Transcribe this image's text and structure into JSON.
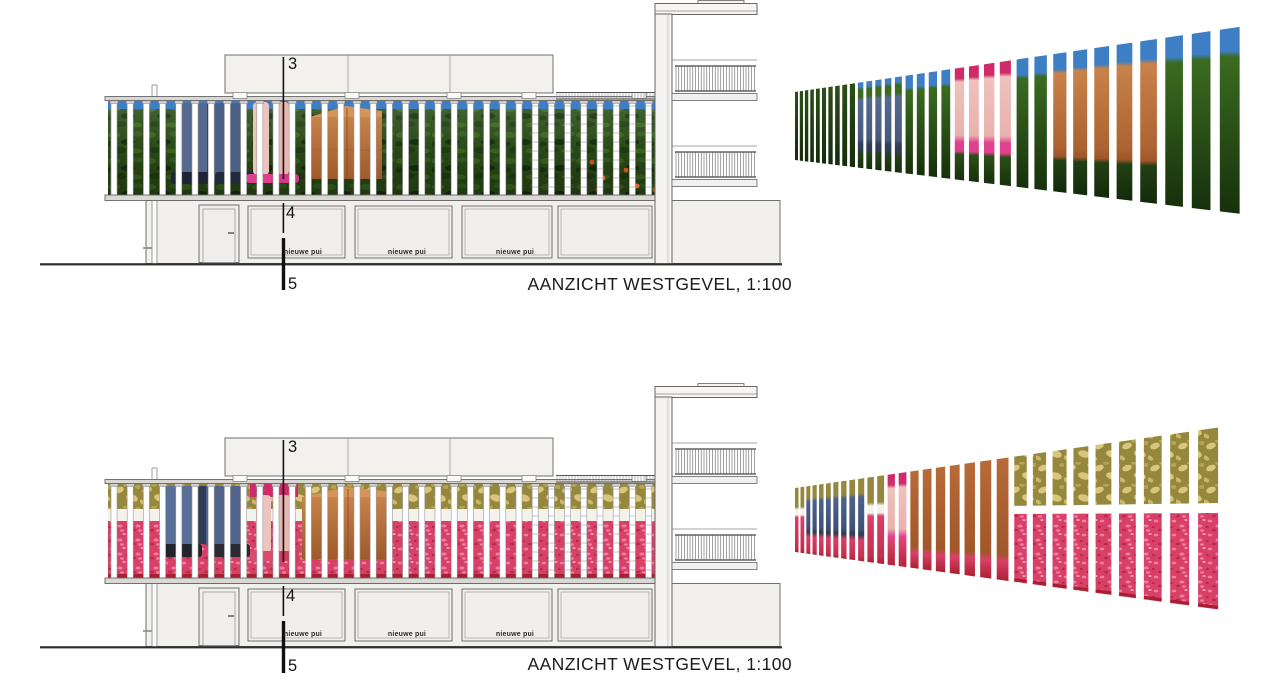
{
  "document": {
    "kind": "architectural elevation sheet",
    "drawing_title": "AANZICHT WESTGEVEL",
    "scale": "1:100"
  },
  "captions": {
    "top": "AANZICHT WESTGEVEL, 1:100",
    "bottom": "AANZICHT WESTGEVEL, 1:100"
  },
  "section_markers": {
    "m3": "3",
    "m4": "4",
    "m5": "5"
  },
  "panel_label": "nieuwe pui",
  "palette": {
    "line": "#4a4a4a",
    "wall_fill": "#f1f0ed",
    "wall_stroke": "#6f6f6f",
    "rail_fill": "#d9d8d4",
    "sky_blue": "#3d7ec4",
    "grass_base": "#2c4f18",
    "grass_light": "#3b6b20",
    "grass_dark": "#16300c",
    "denim": "#56698e",
    "denim_dark": "#2e3c55",
    "skin": "#eec2bd",
    "flipflop_pink": "#e0418f",
    "magenta": "#cf2a6a",
    "box_brown": "#c07a42",
    "box_brown_dark": "#9e5a2b",
    "olive": "#95883e",
    "olive_flower": "#d9c67c",
    "carpet_red": "#d84068",
    "carpet_light": "#ef7f9e",
    "carpet_dark": "#a82030",
    "white_gap": "#f4f2ec",
    "slat_white": "#ffffff",
    "slat_edge": "#9a9a9a",
    "section_line": "#111111"
  },
  "elevations": [
    {
      "id": "west-elevation-summer",
      "variant": "summer",
      "origin_y": 0
    },
    {
      "id": "west-elevation-interior",
      "variant": "interior",
      "origin_y": 383
    }
  ],
  "perspectives": [
    {
      "id": "slat-perspective-summer",
      "variant": "summer",
      "segments": [
        {
          "until": 0.13,
          "type": "grass"
        },
        {
          "until": 0.25,
          "type": "jeans"
        },
        {
          "until": 0.37,
          "type": "grass_sky"
        },
        {
          "until": 0.51,
          "type": "legs"
        },
        {
          "until": 0.59,
          "type": "grass_sky"
        },
        {
          "until": 0.84,
          "type": "box"
        },
        {
          "until": 1.01,
          "type": "grass_sky"
        }
      ]
    },
    {
      "id": "slat-perspective-interior",
      "variant": "interior",
      "segments": [
        {
          "until": 0.02,
          "type": "olive_red"
        },
        {
          "until": 0.16,
          "type": "jeans_red"
        },
        {
          "until": 0.2,
          "type": "olive_red"
        },
        {
          "until": 0.27,
          "type": "legs_red"
        },
        {
          "until": 0.49,
          "type": "box_full"
        },
        {
          "until": 1.01,
          "type": "split"
        }
      ]
    }
  ]
}
